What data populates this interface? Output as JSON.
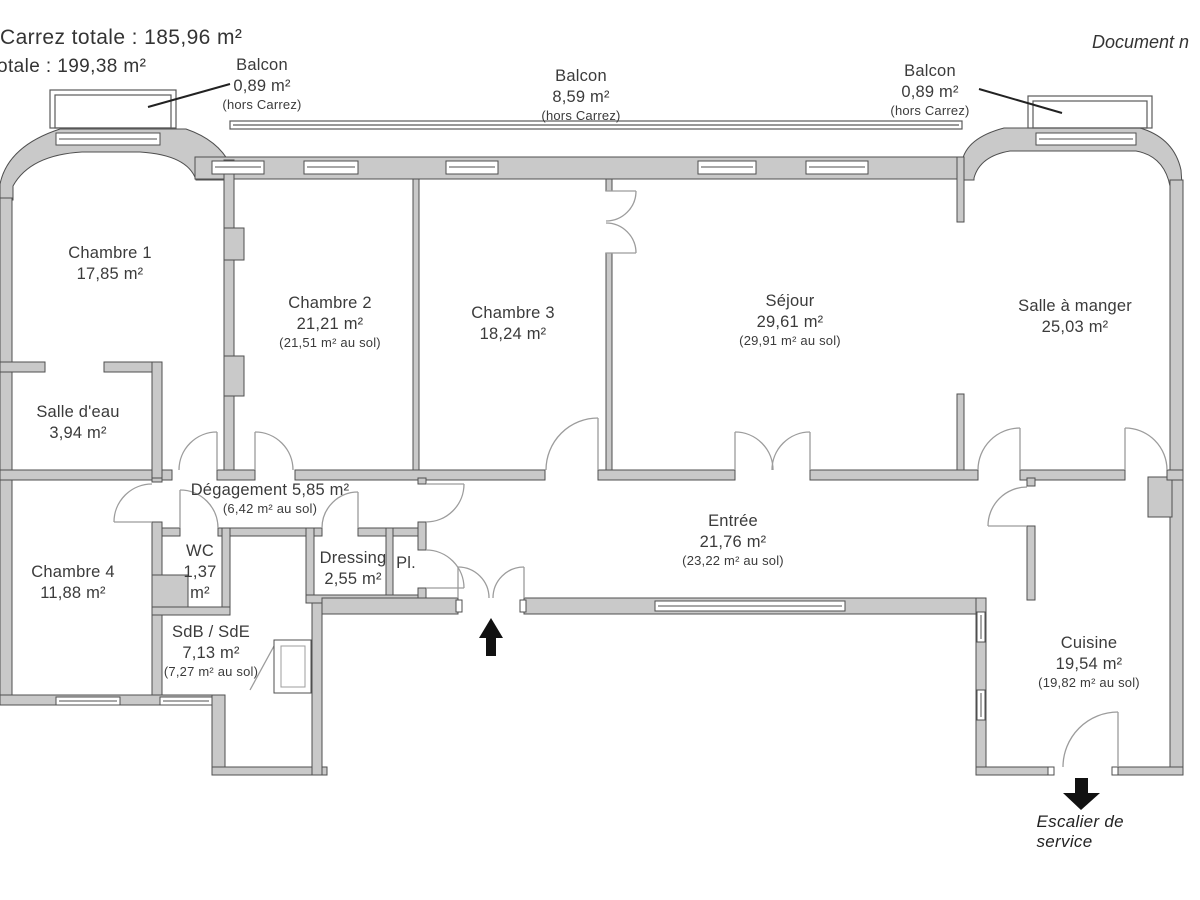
{
  "header": {
    "title_line1": "Carrez totale :  185,96 m²",
    "title_line2": "otale :  199,38 m²",
    "doc_note": "Document n"
  },
  "balconies": [
    {
      "name": "Balcon",
      "area": "0,89 m²",
      "note": "(hors Carrez)"
    },
    {
      "name": "Balcon",
      "area": "8,59 m²",
      "note": "(hors Carrez)"
    },
    {
      "name": "Balcon",
      "area": "0,89 m²",
      "note": "(hors Carrez)"
    }
  ],
  "rooms": {
    "chambre1": {
      "name": "Chambre 1",
      "area": "17,85 m²"
    },
    "chambre2": {
      "name": "Chambre 2",
      "area": "21,21 m²",
      "floor": "(21,51 m² au sol)"
    },
    "chambre3": {
      "name": "Chambre 3",
      "area": "18,24 m²"
    },
    "sejour": {
      "name": "Séjour",
      "area": "29,61 m²",
      "floor": "(29,91 m² au sol)"
    },
    "salle_a_manger": {
      "name": "Salle à manger",
      "area": "25,03 m²"
    },
    "salle_deau": {
      "name": "Salle d'eau",
      "area": "3,94 m²"
    },
    "degagement": {
      "name": "Dégagement 5,85 m²",
      "floor": "(6,42 m² au sol)"
    },
    "wc": {
      "name": "WC",
      "area": "1,37",
      "unit": "m²"
    },
    "chambre4": {
      "name": "Chambre 4",
      "area": "11,88 m²"
    },
    "dressing": {
      "name": "Dressing",
      "area": "2,55 m²"
    },
    "placard": {
      "name": "Pl."
    },
    "entree": {
      "name": "Entrée",
      "area": "21,76 m²",
      "floor": "(23,22 m² au sol)"
    },
    "sdb": {
      "name": "SdB / SdE",
      "area": "7,13 m²",
      "floor": "(7,27 m² au sol)"
    },
    "cuisine": {
      "name": "Cuisine",
      "area": "19,54 m²",
      "floor": "(19,82 m² au sol)"
    }
  },
  "annotations": {
    "service_stair": "Escalier de service"
  },
  "colors": {
    "wall_fill": "#c9c9c9",
    "wall_stroke": "#4f4f4f",
    "door_arc": "#9c9c9c",
    "text": "#3b3b3b",
    "arrow": "#111111"
  }
}
